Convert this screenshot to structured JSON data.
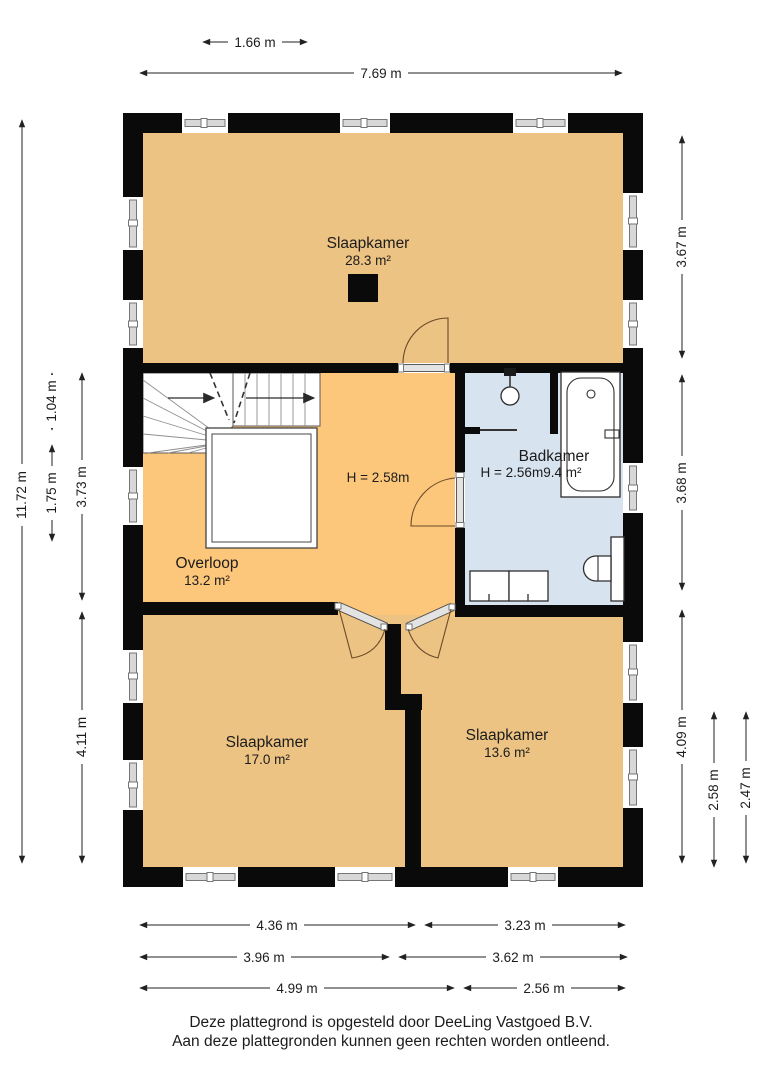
{
  "rooms": {
    "bedroom_top": {
      "name": "Slaapkamer",
      "area": "28.3 m²"
    },
    "landing": {
      "name": "Overloop",
      "area": "13.2 m²",
      "height_note": "H = 2.58m"
    },
    "bathroom": {
      "name": "Badkamer",
      "height_note": "H = 2.56m",
      "area": "9.4 m²"
    },
    "bedroom_left": {
      "name": "Slaapkamer",
      "area": "17.0 m²"
    },
    "bedroom_right": {
      "name": "Slaapkamer",
      "area": "13.6 m²"
    }
  },
  "dims": {
    "top": [
      "1.66 m",
      "7.69 m"
    ],
    "left": [
      "11.72 m",
      "1.04 m",
      "1.75 m",
      "3.73 m",
      "4.11 m"
    ],
    "right": [
      "3.67 m",
      "3.68 m",
      "4.09 m",
      "2.58 m",
      "2.47 m"
    ],
    "bottom": [
      "4.36 m",
      "3.23 m",
      "3.96 m",
      "3.62 m",
      "4.99 m",
      "2.56 m"
    ]
  },
  "footer": {
    "line1": "Deze plattegrond is opgesteld door DeeLing Vastgoed B.V.",
    "line2": "Aan deze plattegronden kunnen geen rechten worden ontleend."
  },
  "colors": {
    "floor_tan": "#ecc382",
    "floor_orange": "#fcc67b",
    "floor_blue": "#d7e3ef",
    "wall": "#0a0a0a"
  }
}
